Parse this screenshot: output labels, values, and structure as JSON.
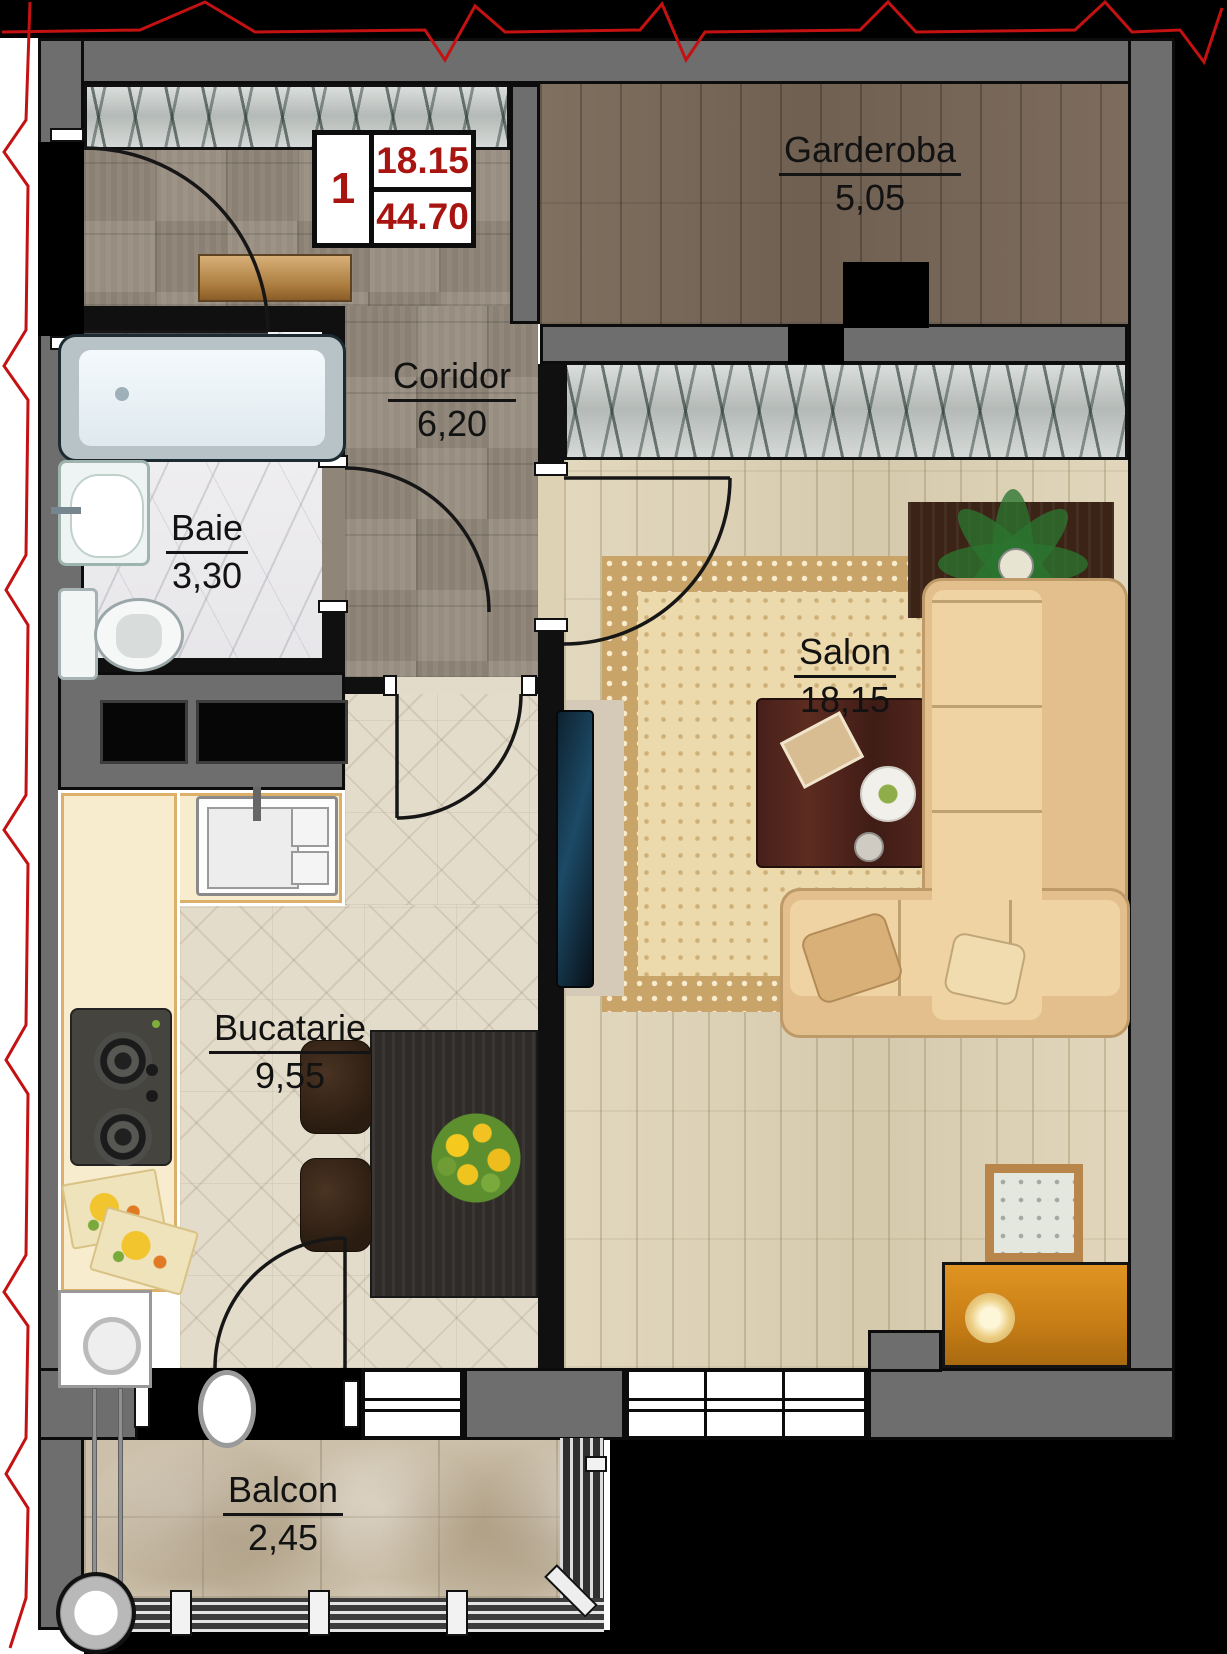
{
  "title": "Apartment floor plan",
  "legend": {
    "unit_number": "1",
    "area_top": "18.15",
    "area_bottom": "44.70"
  },
  "rooms": [
    {
      "id": "garderoba",
      "name": "Garderoba",
      "area": "5,05"
    },
    {
      "id": "coridor",
      "name": "Coridor",
      "area": "6,20"
    },
    {
      "id": "baie",
      "name": "Baie",
      "area": "3,30"
    },
    {
      "id": "salon",
      "name": "Salon",
      "area": "18,15"
    },
    {
      "id": "bucatarie",
      "name": "Bucatarie",
      "area": "9,55"
    },
    {
      "id": "balcon",
      "name": "Balcon",
      "area": "2,45"
    }
  ],
  "palette": {
    "wall_gray": "#6e6e6e",
    "outline_black": "#0c0c0c",
    "legend_red": "#a81410",
    "cut_line_red": "#c41111"
  },
  "icons": [
    "bathtub-icon",
    "sink-icon",
    "toilet-icon",
    "stove-icon",
    "kitchen-sink-icon",
    "washing-machine-icon",
    "dining-table-icon",
    "chair-icon",
    "flower-bouquet-icon",
    "tv-icon",
    "rug-icon",
    "coffee-table-icon",
    "corner-sofa-icon",
    "plant-icon",
    "side-table-icon",
    "dresser-icon",
    "console-icon",
    "wardrobe-hatch-icon",
    "shaft-icon",
    "drain-pipe-icon",
    "railing-icon",
    "door-arc-icon",
    "window-icon"
  ]
}
